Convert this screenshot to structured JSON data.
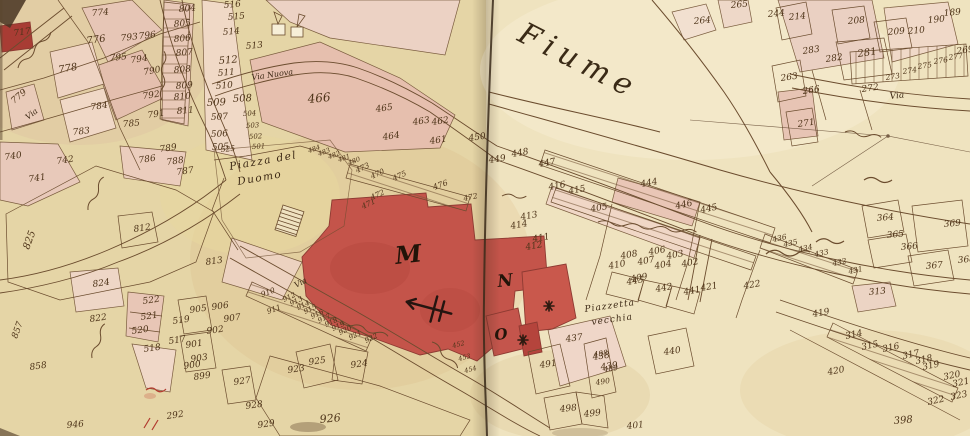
{
  "map": {
    "river_label": "Fiume",
    "piazza_label_line1": "Piazza del",
    "piazza_label_line2": "Duomo",
    "piazzetta_label_line1": "Piazzetta",
    "piazzetta_label_line2": "vecchia",
    "street_labels": {
      "via": "Via",
      "via_nuova": "Via Nuova"
    },
    "building_letters": {
      "duomo": "M",
      "block_n": "N",
      "block_o": "O"
    },
    "colors": {
      "parchment_left": "#e5d5a6",
      "parchment_right": "#f0e4c2",
      "building_pink": "#e6c0b0",
      "building_red": "#c4544a",
      "ink": "#6b4c2e",
      "number_ink": "#4e3419",
      "fold": "#3a2a1a",
      "red_ink": "#b23a2e"
    },
    "parcels": [
      {
        "n": "717",
        "x": 14,
        "y": 36,
        "r": -8
      },
      {
        "n": "774",
        "x": 92,
        "y": 16,
        "r": -5
      },
      {
        "n": "776",
        "x": 87,
        "y": 44,
        "r": -8,
        "s": 10
      },
      {
        "n": "778",
        "x": 59,
        "y": 73,
        "r": -10,
        "s": 10
      },
      {
        "n": "779",
        "x": 14,
        "y": 104,
        "r": -40
      },
      {
        "n": "784",
        "x": 91,
        "y": 110,
        "r": -8
      },
      {
        "n": "783",
        "x": 73,
        "y": 135,
        "r": -6
      },
      {
        "n": "785",
        "x": 123,
        "y": 127,
        "r": -5
      },
      {
        "n": "790",
        "x": 144,
        "y": 75,
        "r": -10
      },
      {
        "n": "792",
        "x": 143,
        "y": 99,
        "r": -8
      },
      {
        "n": "791",
        "x": 148,
        "y": 118,
        "r": -8
      },
      {
        "n": "793",
        "x": 121,
        "y": 41,
        "r": -6
      },
      {
        "n": "795",
        "x": 110,
        "y": 61,
        "r": -6
      },
      {
        "n": "794",
        "x": 131,
        "y": 63,
        "r": -8
      },
      {
        "n": "796",
        "x": 139,
        "y": 39,
        "r": -6
      },
      {
        "n": "804",
        "x": 179,
        "y": 12,
        "r": -5
      },
      {
        "n": "805",
        "x": 174,
        "y": 27,
        "r": -5
      },
      {
        "n": "806",
        "x": 174,
        "y": 42,
        "r": -5
      },
      {
        "n": "807",
        "x": 176,
        "y": 56,
        "r": -5
      },
      {
        "n": "808",
        "x": 174,
        "y": 73,
        "r": -5
      },
      {
        "n": "809",
        "x": 176,
        "y": 89,
        "r": -5
      },
      {
        "n": "810",
        "x": 174,
        "y": 100,
        "r": -5
      },
      {
        "n": "811",
        "x": 177,
        "y": 114,
        "r": -5
      },
      {
        "n": "516",
        "x": 224,
        "y": 8,
        "r": -5
      },
      {
        "n": "515",
        "x": 228,
        "y": 20,
        "r": -5
      },
      {
        "n": "514",
        "x": 223,
        "y": 35,
        "r": -5
      },
      {
        "n": "513",
        "x": 246,
        "y": 49,
        "r": -5
      },
      {
        "n": "512",
        "x": 219,
        "y": 64,
        "r": -5,
        "s": 10
      },
      {
        "n": "511",
        "x": 218,
        "y": 76,
        "r": -5
      },
      {
        "n": "510",
        "x": 216,
        "y": 89,
        "r": -5
      },
      {
        "n": "509",
        "x": 207,
        "y": 106,
        "r": -3,
        "s": 10
      },
      {
        "n": "508",
        "x": 233,
        "y": 102,
        "r": -3,
        "s": 10
      },
      {
        "n": "507",
        "x": 211,
        "y": 120,
        "r": -3
      },
      {
        "n": "506",
        "x": 211,
        "y": 137,
        "r": -3
      },
      {
        "n": "505",
        "x": 212,
        "y": 150,
        "r": -3
      },
      {
        "n": "504",
        "x": 243,
        "y": 116,
        "r": -3,
        "s": 7
      },
      {
        "n": "503",
        "x": 246,
        "y": 128,
        "r": -3,
        "s": 7
      },
      {
        "n": "502",
        "x": 249,
        "y": 139,
        "r": -3,
        "s": 7
      },
      {
        "n": "501",
        "x": 252,
        "y": 149,
        "r": -3,
        "s": 7
      },
      {
        "n": "525",
        "x": 221,
        "y": 152,
        "r": -5,
        "s": 7.5
      },
      {
        "n": "466",
        "x": 308,
        "y": 103,
        "r": -5,
        "s": 12
      },
      {
        "n": "465",
        "x": 376,
        "y": 112,
        "r": -8
      },
      {
        "n": "464",
        "x": 383,
        "y": 140,
        "r": -8
      },
      {
        "n": "463",
        "x": 413,
        "y": 125,
        "r": -8
      },
      {
        "n": "462",
        "x": 432,
        "y": 125,
        "r": -8
      },
      {
        "n": "461",
        "x": 430,
        "y": 144,
        "r": -8
      },
      {
        "n": "450",
        "x": 469,
        "y": 141,
        "r": -8
      },
      {
        "n": "449",
        "x": 489,
        "y": 163,
        "r": -8
      },
      {
        "n": "448",
        "x": 512,
        "y": 157,
        "r": -10
      },
      {
        "n": "447",
        "x": 539,
        "y": 167,
        "r": -10
      },
      {
        "n": "473",
        "x": 357,
        "y": 173,
        "r": -25,
        "s": 7.5
      },
      {
        "n": "470",
        "x": 372,
        "y": 179,
        "r": -25,
        "s": 7.5
      },
      {
        "n": "475",
        "x": 394,
        "y": 181,
        "r": -25,
        "s": 7.5
      },
      {
        "n": "476",
        "x": 434,
        "y": 190,
        "r": -20,
        "s": 8
      },
      {
        "n": "472",
        "x": 372,
        "y": 200,
        "r": -25,
        "s": 7.5
      },
      {
        "n": "471",
        "x": 363,
        "y": 209,
        "r": -25,
        "s": 7.5
      },
      {
        "n": "472",
        "x": 464,
        "y": 201,
        "r": -12,
        "s": 7.5
      },
      {
        "n": "484",
        "x": 309,
        "y": 153,
        "r": -20,
        "s": 6.5
      },
      {
        "n": "483",
        "x": 319,
        "y": 156,
        "r": -20,
        "s": 6.5
      },
      {
        "n": "482",
        "x": 329,
        "y": 159,
        "r": -20,
        "s": 6.5
      },
      {
        "n": "481",
        "x": 339,
        "y": 162,
        "r": -20,
        "s": 6.5
      },
      {
        "n": "480",
        "x": 349,
        "y": 165,
        "r": -20,
        "s": 6.5
      },
      {
        "n": "452",
        "x": 453,
        "y": 348,
        "r": -15,
        "s": 6.5
      },
      {
        "n": "453",
        "x": 459,
        "y": 361,
        "r": -15,
        "s": 6.5
      },
      {
        "n": "454",
        "x": 465,
        "y": 373,
        "r": -15,
        "s": 6.5
      },
      {
        "n": "416",
        "x": 549,
        "y": 190,
        "r": -10
      },
      {
        "n": "415",
        "x": 569,
        "y": 194,
        "r": -10
      },
      {
        "n": "405",
        "x": 591,
        "y": 212,
        "r": -10
      },
      {
        "n": "413",
        "x": 521,
        "y": 220,
        "r": -10
      },
      {
        "n": "414",
        "x": 511,
        "y": 229,
        "r": -10
      },
      {
        "n": "411",
        "x": 533,
        "y": 242,
        "r": -10
      },
      {
        "n": "412",
        "x": 526,
        "y": 250,
        "r": -10
      },
      {
        "n": "410",
        "x": 609,
        "y": 269,
        "r": -10
      },
      {
        "n": "408",
        "x": 621,
        "y": 259,
        "r": -10
      },
      {
        "n": "407",
        "x": 638,
        "y": 265,
        "r": -10
      },
      {
        "n": "406",
        "x": 649,
        "y": 255,
        "r": -10
      },
      {
        "n": "409",
        "x": 631,
        "y": 282,
        "r": -10
      },
      {
        "n": "404",
        "x": 655,
        "y": 269,
        "r": -10
      },
      {
        "n": "403",
        "x": 667,
        "y": 259,
        "r": -10
      },
      {
        "n": "402",
        "x": 682,
        "y": 267,
        "r": -10
      },
      {
        "n": "444",
        "x": 641,
        "y": 187,
        "r": -10
      },
      {
        "n": "446",
        "x": 676,
        "y": 209,
        "r": -12
      },
      {
        "n": "445",
        "x": 701,
        "y": 213,
        "r": -12
      },
      {
        "n": "443",
        "x": 627,
        "y": 285,
        "r": -10
      },
      {
        "n": "442",
        "x": 656,
        "y": 292,
        "r": -10
      },
      {
        "n": "441",
        "x": 684,
        "y": 295,
        "r": -10
      },
      {
        "n": "440",
        "x": 664,
        "y": 355,
        "r": -8
      },
      {
        "n": "437",
        "x": 566,
        "y": 342,
        "r": -8
      },
      {
        "n": "438",
        "x": 593,
        "y": 360,
        "r": -8
      },
      {
        "n": "439",
        "x": 601,
        "y": 370,
        "r": -8
      },
      {
        "n": "491",
        "x": 540,
        "y": 368,
        "r": -8
      },
      {
        "n": "488",
        "x": 594,
        "y": 357,
        "r": -8,
        "s": 7.5
      },
      {
        "n": "489",
        "x": 604,
        "y": 372,
        "r": -8,
        "s": 7.5
      },
      {
        "n": "490",
        "x": 596,
        "y": 385,
        "r": -8,
        "s": 7.5
      },
      {
        "n": "498",
        "x": 560,
        "y": 412,
        "r": -6
      },
      {
        "n": "499",
        "x": 584,
        "y": 417,
        "r": -6
      },
      {
        "n": "401",
        "x": 627,
        "y": 429,
        "r": -6
      },
      {
        "n": "421",
        "x": 701,
        "y": 291,
        "r": -10
      },
      {
        "n": "422",
        "x": 744,
        "y": 289,
        "r": -10
      },
      {
        "n": "436",
        "x": 773,
        "y": 242,
        "r": -12,
        "s": 7.5
      },
      {
        "n": "435",
        "x": 784,
        "y": 247,
        "r": -12,
        "s": 7.5
      },
      {
        "n": "434",
        "x": 799,
        "y": 252,
        "r": -12,
        "s": 7.5
      },
      {
        "n": "433",
        "x": 815,
        "y": 257,
        "r": -12,
        "s": 7.5
      },
      {
        "n": "432",
        "x": 833,
        "y": 266,
        "r": -12,
        "s": 7.5
      },
      {
        "n": "431",
        "x": 849,
        "y": 274,
        "r": -12,
        "s": 7.5
      },
      {
        "n": "364",
        "x": 877,
        "y": 221,
        "r": -5
      },
      {
        "n": "365",
        "x": 887,
        "y": 238,
        "r": -5
      },
      {
        "n": "366",
        "x": 901,
        "y": 250,
        "r": -5
      },
      {
        "n": "369",
        "x": 944,
        "y": 227,
        "r": -5
      },
      {
        "n": "367",
        "x": 926,
        "y": 269,
        "r": -5
      },
      {
        "n": "368",
        "x": 958,
        "y": 263,
        "r": -5
      },
      {
        "n": "214",
        "x": 789,
        "y": 20,
        "r": -5
      },
      {
        "n": "208",
        "x": 848,
        "y": 24,
        "r": -5
      },
      {
        "n": "209",
        "x": 888,
        "y": 35,
        "r": -5
      },
      {
        "n": "210",
        "x": 908,
        "y": 34,
        "r": -5
      },
      {
        "n": "190",
        "x": 928,
        "y": 23,
        "r": -5
      },
      {
        "n": "189",
        "x": 944,
        "y": 16,
        "r": -5
      },
      {
        "n": "281",
        "x": 858,
        "y": 57,
        "r": -8,
        "s": 10
      },
      {
        "n": "282",
        "x": 826,
        "y": 62,
        "r": -8
      },
      {
        "n": "283",
        "x": 803,
        "y": 54,
        "r": -8
      },
      {
        "n": "263",
        "x": 781,
        "y": 81,
        "r": -8
      },
      {
        "n": "266",
        "x": 803,
        "y": 94,
        "r": -8
      },
      {
        "n": "269",
        "x": 957,
        "y": 54,
        "r": -8
      },
      {
        "n": "277",
        "x": 949,
        "y": 60,
        "r": -8,
        "s": 7.5
      },
      {
        "n": "276",
        "x": 934,
        "y": 64,
        "r": -8,
        "s": 7.5
      },
      {
        "n": "275",
        "x": 918,
        "y": 69,
        "r": -8,
        "s": 7.5
      },
      {
        "n": "274",
        "x": 903,
        "y": 74,
        "r": -8,
        "s": 7.5
      },
      {
        "n": "273",
        "x": 886,
        "y": 80,
        "r": -8,
        "s": 7.5
      },
      {
        "n": "272",
        "x": 862,
        "y": 92,
        "r": -8
      },
      {
        "n": "271",
        "x": 798,
        "y": 127,
        "r": -8
      },
      {
        "n": "264",
        "x": 694,
        "y": 24,
        "r": -5
      },
      {
        "n": "265",
        "x": 731,
        "y": 8,
        "r": -5
      },
      {
        "n": "244",
        "x": 768,
        "y": 17,
        "r": -5
      },
      {
        "n": "313",
        "x": 869,
        "y": 295,
        "r": -5
      },
      {
        "n": "419",
        "x": 813,
        "y": 317,
        "r": -10
      },
      {
        "n": "314",
        "x": 846,
        "y": 339,
        "r": -12
      },
      {
        "n": "315",
        "x": 862,
        "y": 350,
        "r": -12
      },
      {
        "n": "316",
        "x": 883,
        "y": 352,
        "r": -12
      },
      {
        "n": "317",
        "x": 903,
        "y": 359,
        "r": -12
      },
      {
        "n": "318",
        "x": 916,
        "y": 364,
        "r": -12
      },
      {
        "n": "319",
        "x": 923,
        "y": 370,
        "r": -12
      },
      {
        "n": "320",
        "x": 944,
        "y": 380,
        "r": -12
      },
      {
        "n": "321",
        "x": 953,
        "y": 387,
        "r": -12
      },
      {
        "n": "322",
        "x": 928,
        "y": 405,
        "r": -12
      },
      {
        "n": "323",
        "x": 951,
        "y": 400,
        "r": -12
      },
      {
        "n": "398",
        "x": 894,
        "y": 424,
        "r": -5,
        "s": 10
      },
      {
        "n": "420",
        "x": 828,
        "y": 375,
        "r": -10
      },
      {
        "n": "905",
        "x": 190,
        "y": 313,
        "r": -8
      },
      {
        "n": "906",
        "x": 212,
        "y": 310,
        "r": -8
      },
      {
        "n": "907",
        "x": 224,
        "y": 322,
        "r": -8
      },
      {
        "n": "902",
        "x": 207,
        "y": 334,
        "r": -8
      },
      {
        "n": "901",
        "x": 186,
        "y": 348,
        "r": -8
      },
      {
        "n": "903",
        "x": 191,
        "y": 362,
        "r": -8
      },
      {
        "n": "900",
        "x": 184,
        "y": 369,
        "r": -8
      },
      {
        "n": "899",
        "x": 194,
        "y": 380,
        "r": -8
      },
      {
        "n": "927",
        "x": 234,
        "y": 385,
        "r": -8
      },
      {
        "n": "928",
        "x": 246,
        "y": 409,
        "r": -8
      },
      {
        "n": "929",
        "x": 258,
        "y": 428,
        "r": -8
      },
      {
        "n": "910",
        "x": 262,
        "y": 297,
        "r": -20,
        "s": 7.5
      },
      {
        "n": "911",
        "x": 268,
        "y": 314,
        "r": -20,
        "s": 7.5
      },
      {
        "n": "912",
        "x": 284,
        "y": 302,
        "r": -25,
        "s": 7
      },
      {
        "n": "913",
        "x": 291,
        "y": 306,
        "r": -25,
        "s": 7
      },
      {
        "n": "914",
        "x": 298,
        "y": 310,
        "r": -25,
        "s": 7
      },
      {
        "n": "915",
        "x": 305,
        "y": 314,
        "r": -25,
        "s": 7
      },
      {
        "n": "916",
        "x": 312,
        "y": 319,
        "r": -25,
        "s": 7
      },
      {
        "n": "917",
        "x": 319,
        "y": 323,
        "r": -25,
        "s": 7
      },
      {
        "n": "918",
        "x": 326,
        "y": 327,
        "r": -25,
        "s": 7
      },
      {
        "n": "919",
        "x": 333,
        "y": 331,
        "r": -25,
        "s": 7
      },
      {
        "n": "920",
        "x": 340,
        "y": 335,
        "r": -25,
        "s": 7
      },
      {
        "n": "921",
        "x": 350,
        "y": 340,
        "r": -25,
        "s": 7
      },
      {
        "n": "922",
        "x": 366,
        "y": 343,
        "r": -25,
        "s": 7
      },
      {
        "n": "923",
        "x": 288,
        "y": 373,
        "r": -8
      },
      {
        "n": "925",
        "x": 309,
        "y": 365,
        "r": -8
      },
      {
        "n": "924",
        "x": 351,
        "y": 368,
        "r": -8
      },
      {
        "n": "926",
        "x": 320,
        "y": 423,
        "r": -5,
        "s": 11
      },
      {
        "n": "946",
        "x": 67,
        "y": 428,
        "r": -5
      },
      {
        "n": "824",
        "x": 93,
        "y": 287,
        "r": -8
      },
      {
        "n": "822",
        "x": 90,
        "y": 322,
        "r": -8
      },
      {
        "n": "857",
        "x": 17,
        "y": 339,
        "r": -70
      },
      {
        "n": "858",
        "x": 30,
        "y": 370,
        "r": -8
      },
      {
        "n": "522",
        "x": 143,
        "y": 304,
        "r": -8
      },
      {
        "n": "521",
        "x": 141,
        "y": 320,
        "r": -8
      },
      {
        "n": "520",
        "x": 132,
        "y": 334,
        "r": -8
      },
      {
        "n": "518",
        "x": 144,
        "y": 352,
        "r": -8
      },
      {
        "n": "519",
        "x": 173,
        "y": 324,
        "r": -8
      },
      {
        "n": "517",
        "x": 169,
        "y": 344,
        "r": -8
      },
      {
        "n": "292",
        "x": 167,
        "y": 419,
        "r": -8
      },
      {
        "n": "740",
        "x": 5,
        "y": 160,
        "r": -8
      },
      {
        "n": "742",
        "x": 57,
        "y": 164,
        "r": -8
      },
      {
        "n": "741",
        "x": 29,
        "y": 182,
        "r": -8
      },
      {
        "n": "786",
        "x": 139,
        "y": 163,
        "r": -8
      },
      {
        "n": "789",
        "x": 160,
        "y": 152,
        "r": -8
      },
      {
        "n": "788",
        "x": 167,
        "y": 165,
        "r": -8
      },
      {
        "n": "787",
        "x": 177,
        "y": 175,
        "r": -8
      },
      {
        "n": "812",
        "x": 134,
        "y": 232,
        "r": -8
      },
      {
        "n": "825",
        "x": 29,
        "y": 250,
        "r": -70,
        "s": 10
      },
      {
        "n": "813",
        "x": 206,
        "y": 265,
        "r": -8
      }
    ]
  }
}
